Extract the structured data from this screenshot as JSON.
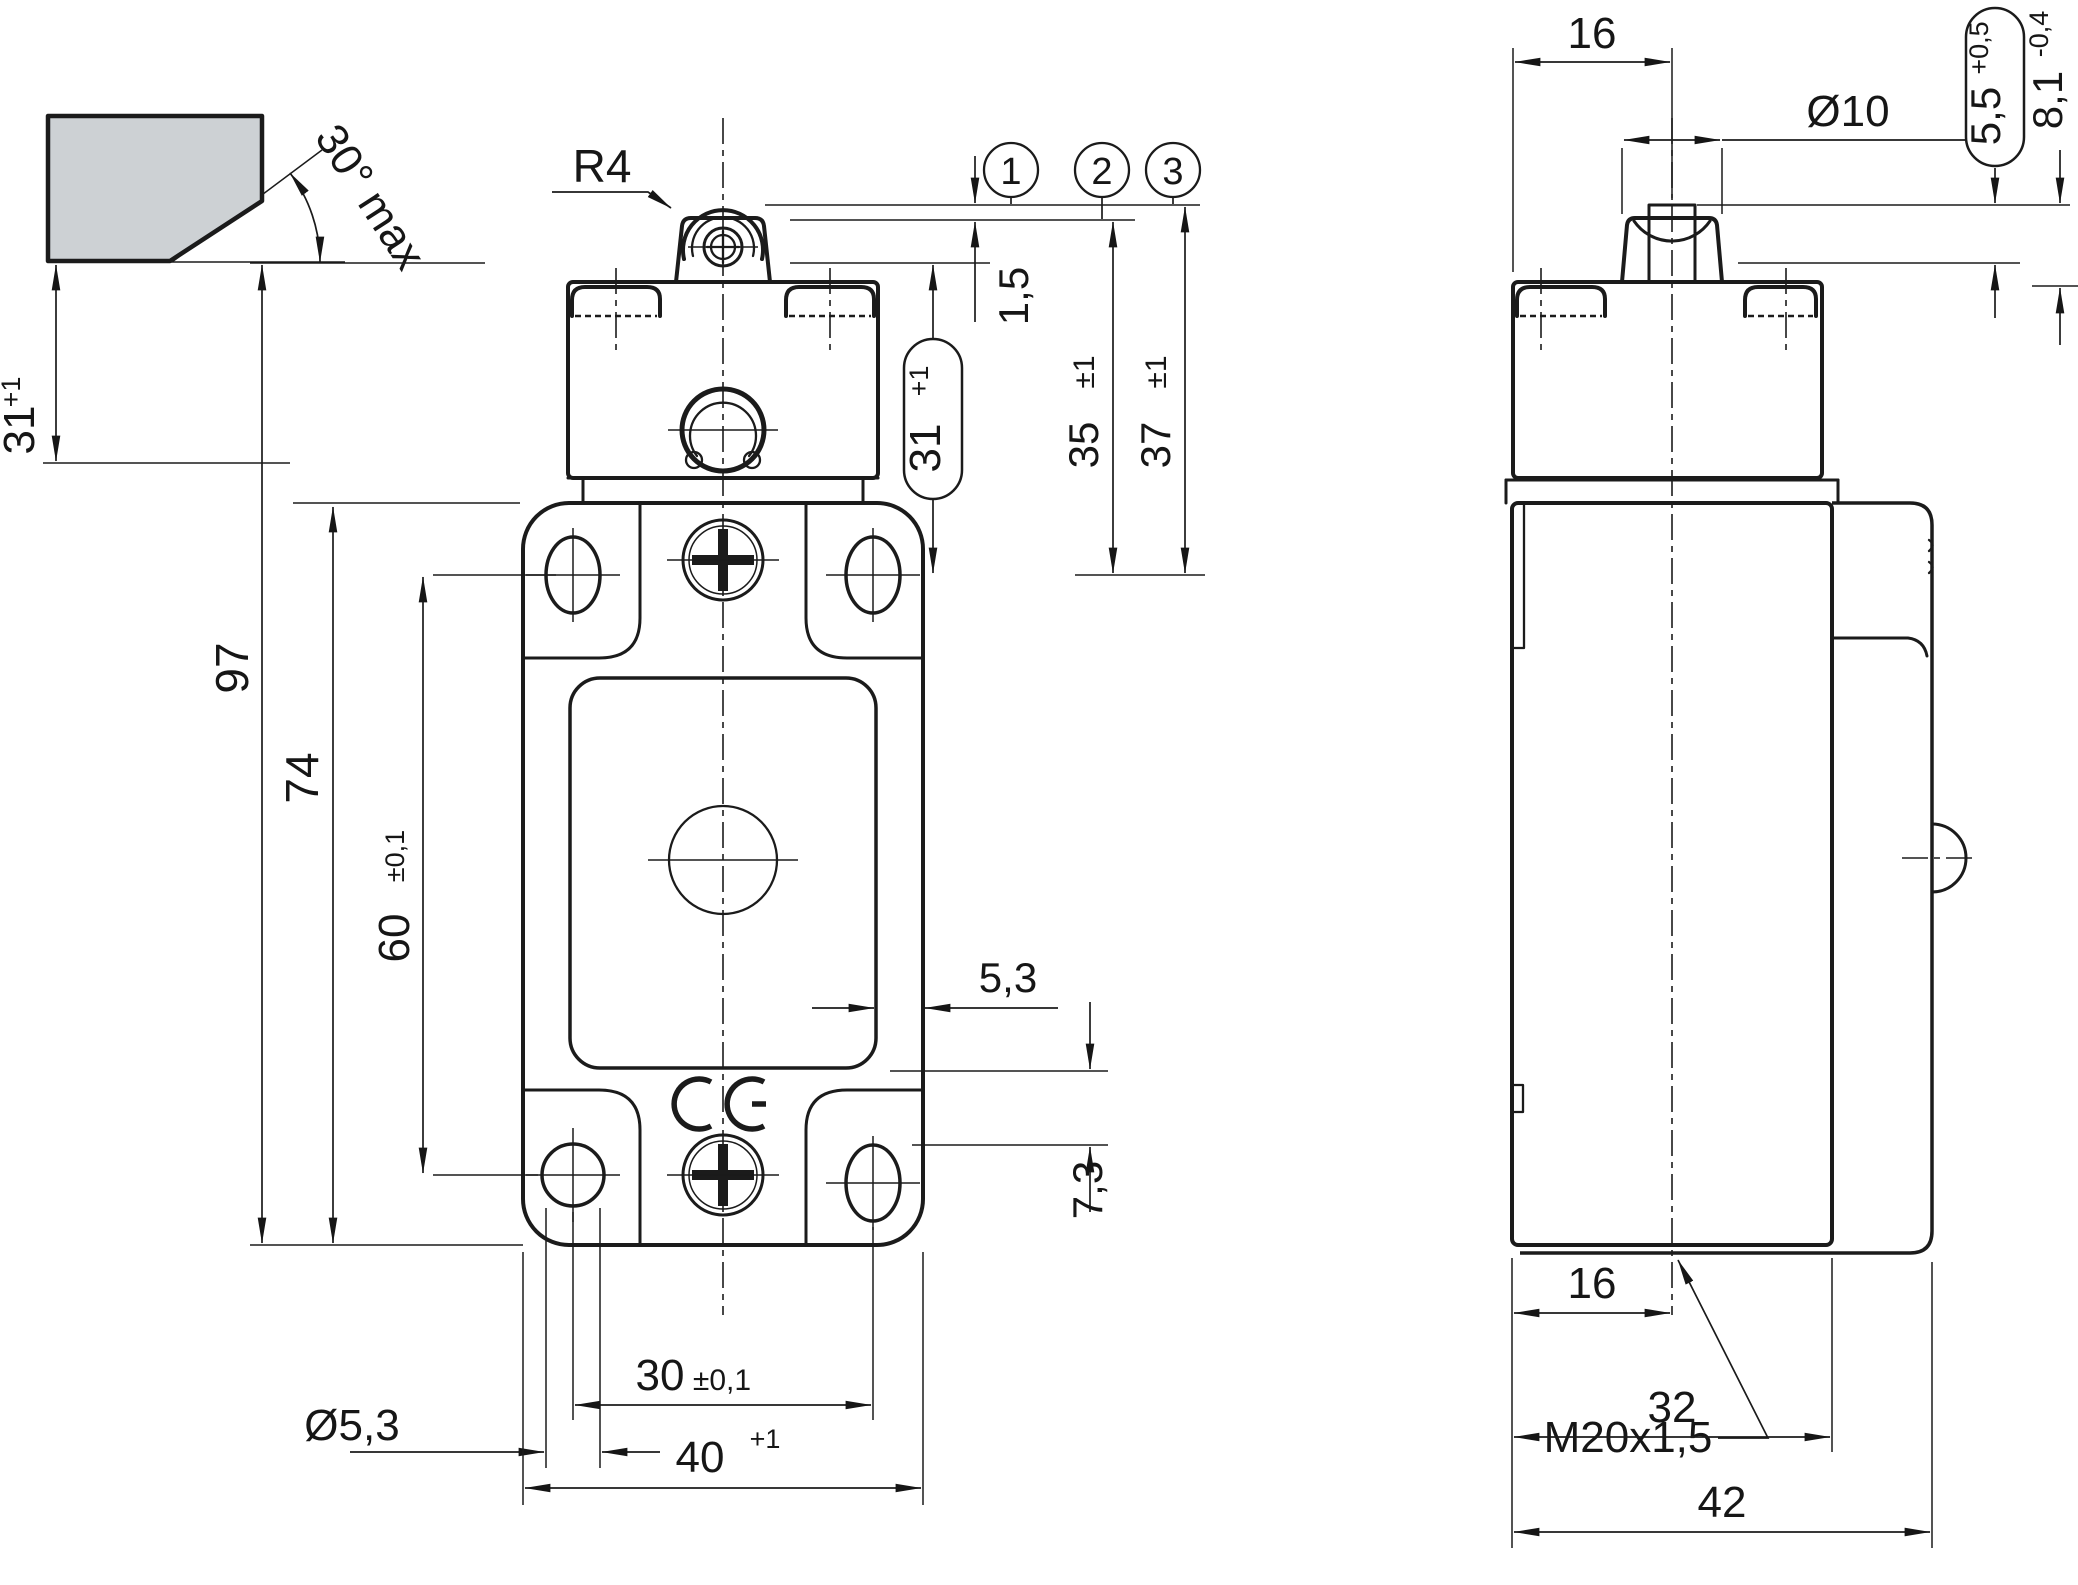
{
  "drawing": {
    "kind": "dimensional-drawing-position-switch-roller-plunger",
    "colors": {
      "line": "#1b1b1b",
      "cam_fill": "#cdd1d4"
    },
    "front": {
      "cam_angle": "30° max",
      "roller_radius": "R4",
      "positions": {
        "p1": "1",
        "p2": "2",
        "p3": "3"
      },
      "pretravel": "1,5",
      "dim31_cap": {
        "v": "31",
        "t": "+1"
      },
      "dim35": {
        "v": "35",
        "t": "±1"
      },
      "dim37": {
        "v": "37",
        "t": "±1"
      },
      "dim31_left": {
        "v": "31",
        "t": "+1"
      },
      "dim97": "97",
      "dim74": "74",
      "dim60": {
        "v": "60",
        "t": "±0,1"
      },
      "hole_dia": "Ø5,3",
      "dim30": {
        "v": "30",
        "t": "±0,1"
      },
      "dim40": {
        "v": "40",
        "t": "+1"
      },
      "gap53": "5,3",
      "dim73": "7,3",
      "ce": "CE"
    },
    "side": {
      "dim16_top": "16",
      "plunger_dia": "Ø10",
      "dim55": {
        "v": "5,5",
        "t": "+0,5"
      },
      "dim81": {
        "v": "8,1",
        "t": "-0,4"
      },
      "dim16_bottom": "16",
      "thread": "M20x1,5",
      "dim32": "32",
      "dim42": "42"
    }
  }
}
